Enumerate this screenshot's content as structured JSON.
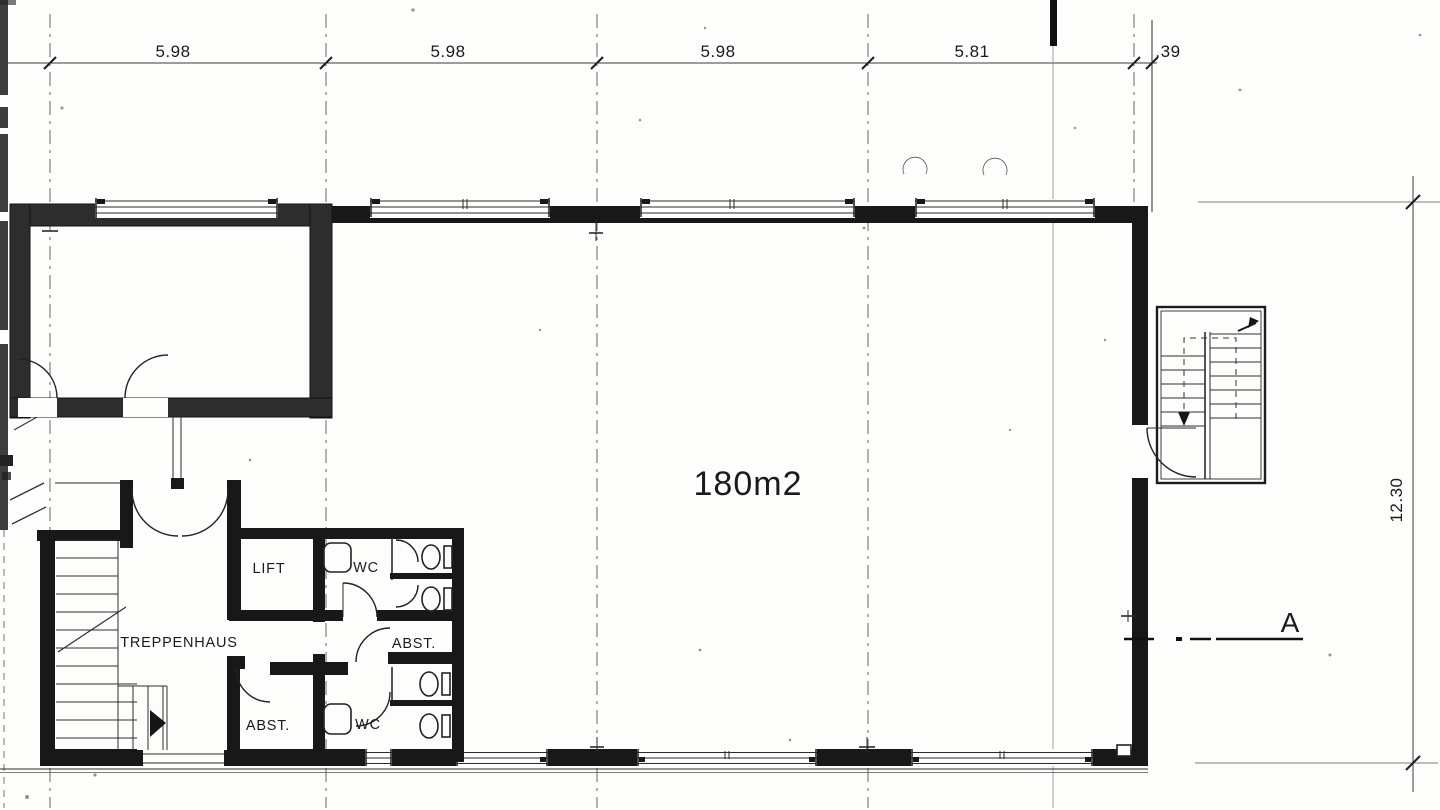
{
  "dimension_chain_top": {
    "values": [
      "5.98",
      "5.98",
      "5.98",
      "5.81",
      ".39"
    ]
  },
  "dimension_right": {
    "value": "12.30"
  },
  "rooms": {
    "hall_area": "180m2",
    "lift": "LIFT",
    "wc_upper": "WC",
    "abst_upper": "ABST.",
    "treppenhaus": "TREPPENHAUS",
    "abst_lower": "ABST.",
    "wc_lower": "WC"
  },
  "section_marker": {
    "label": "A"
  },
  "colors": {
    "paper": "#fdfdfb",
    "ink": "#1b1b1b",
    "wall": "#181818",
    "wall_gray": "#2d2d2d"
  }
}
